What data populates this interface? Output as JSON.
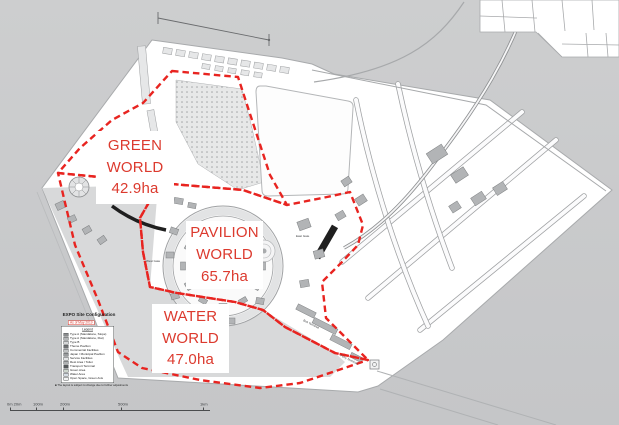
{
  "zones": {
    "green": {
      "name_line1": "GREEN",
      "name_line2": "WORLD",
      "area": "42.9ha"
    },
    "pavilion": {
      "name_line1": "PAVILION",
      "name_line2": "WORLD",
      "area": "65.7ha"
    },
    "water": {
      "name_line1": "WATER",
      "name_line2": "WORLD",
      "area": "47.0ha"
    }
  },
  "legend": {
    "title": "EXPO Site Configuration",
    "subtitle": "As of May 2019",
    "panel_heading": "Legend",
    "items": [
      {
        "label": "Type A (Standalone, Slope)",
        "color": "#8a8c8e"
      },
      {
        "label": "Type A (Standalone, Flat)",
        "color": "#b4b6b8"
      },
      {
        "label": "Type B",
        "color": "#d6d7d8"
      },
      {
        "label": "Theme Pavilion",
        "color": "#6e7072"
      },
      {
        "label": "Commercial Facilities",
        "color": "#c2c4c5"
      },
      {
        "label": "Japan / Municipal Pavilion",
        "color": "#9a9c9e"
      },
      {
        "label": "Service Facilities",
        "color": "#e4e5e6"
      },
      {
        "label": "Rest Area / Toilet",
        "color": "#b0b2b3"
      },
      {
        "label": "Transport Terminal",
        "color": "#55585a"
      },
      {
        "label": "Green Area",
        "color": "#cdd6cd"
      },
      {
        "label": "Water Area",
        "color": "#d6dde4"
      },
      {
        "label": "Open Space, Green Axis",
        "color": "#f2f3f3"
      }
    ],
    "footnote": "■ The layout is subject to change due to further adjustments"
  },
  "scale_bar": {
    "labels": [
      "0m 20m",
      "100m",
      "200m",
      "500m",
      "1km"
    ]
  },
  "map_labels": {
    "east_gate": "East Gate",
    "west_gate": "West Gate",
    "bus_terminal": "Bus Terminal",
    "ferry_terminal": "Ferry Terminal"
  },
  "colors": {
    "background_top": "#cdcecf",
    "background_bottom": "#c5c6c8",
    "land": "#ffffff",
    "water_basin": "#d8d9da",
    "boundary_red": "#e82420",
    "label_red": "#dc3a2e",
    "building_gray": "#b2b4b6",
    "structure_black": "#1f1f1f"
  }
}
